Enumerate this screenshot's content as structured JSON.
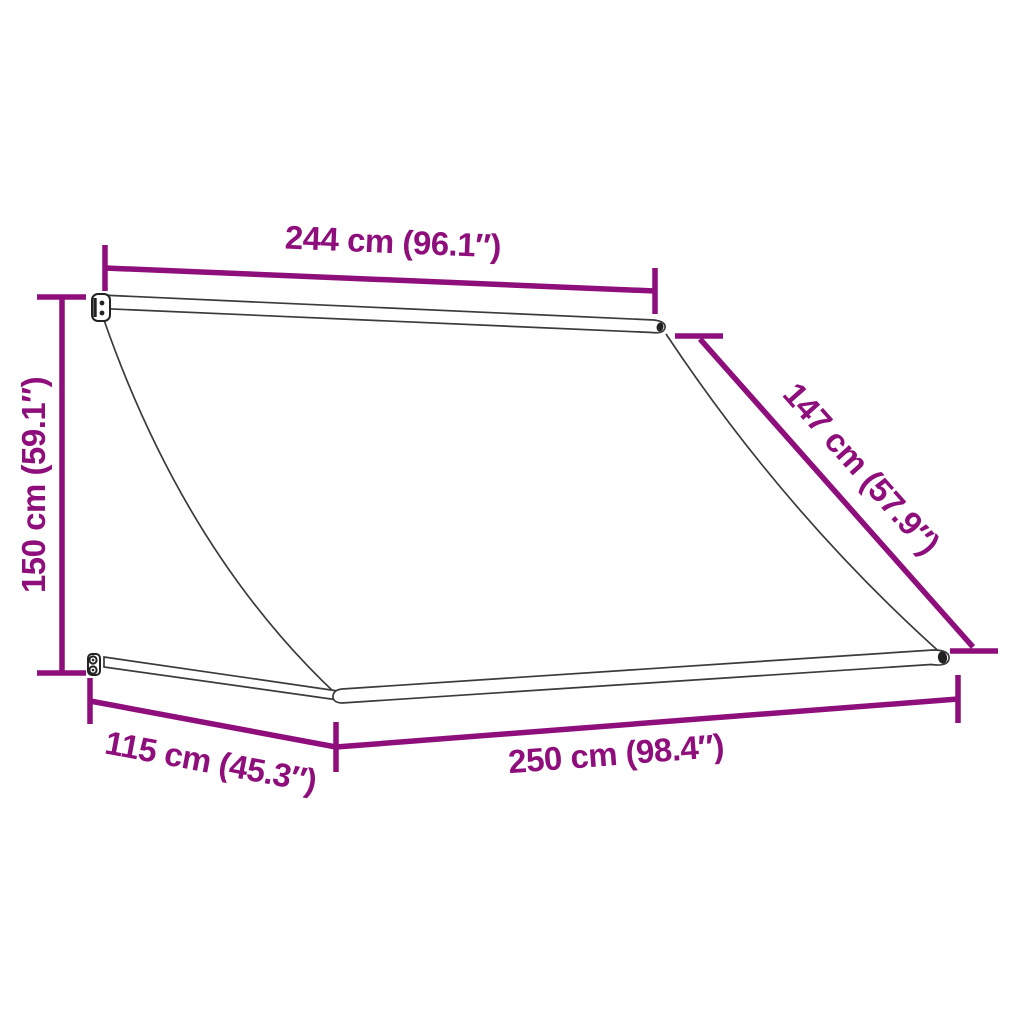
{
  "diagram": {
    "kind": "awning-dimension-drawing",
    "colors": {
      "accent": "#8E0E7C",
      "drawing_line": "#3b3b3b",
      "background": "#ffffff"
    },
    "dimensions": {
      "top_width": {
        "label": "244 cm (96.1″)",
        "value_cm": 244,
        "value_in": 96.1
      },
      "height": {
        "label": "150 cm (59.1″)",
        "value_cm": 150,
        "value_in": 59.1
      },
      "side_slope": {
        "label": "147 cm (57.9″)",
        "value_cm": 147,
        "value_in": 57.9
      },
      "depth": {
        "label": "115 cm (45.3″)",
        "value_cm": 115,
        "value_in": 45.3
      },
      "bottom_width": {
        "label": "250 cm (98.4″)",
        "value_cm": 250,
        "value_in": 98.4
      }
    }
  }
}
